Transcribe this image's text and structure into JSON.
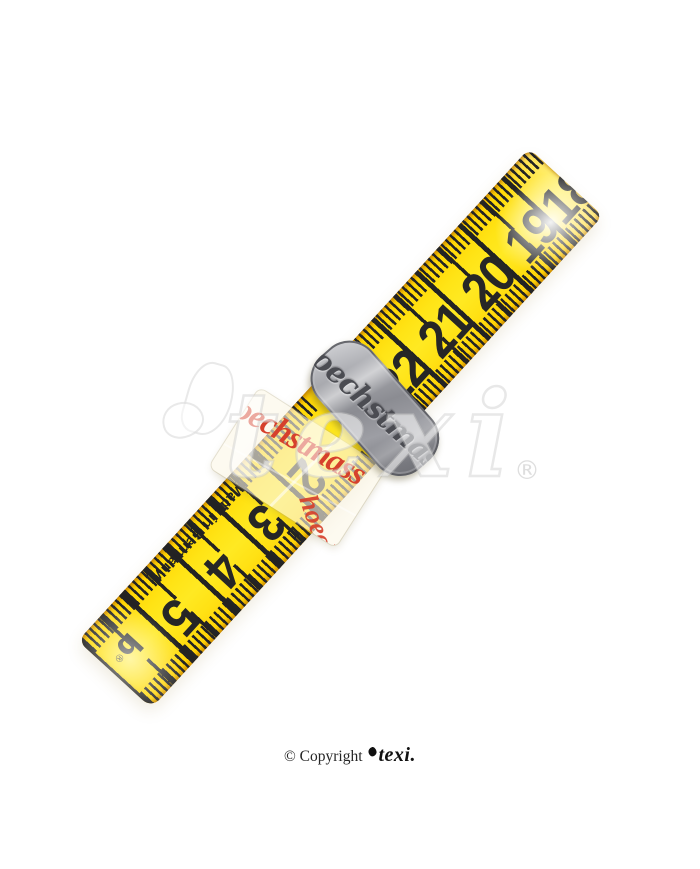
{
  "photo": {
    "background_color": "#ffffff",
    "tape": {
      "color_yellow": "#ffe114",
      "tick_color": "#232323",
      "upper_scale": [
        "18",
        "19",
        "20",
        "21",
        "22"
      ],
      "lower_scale": [
        "2",
        "3",
        "4",
        "5"
      ],
      "made_in_label": "Made in Germany",
      "tape_logo_letter": "b",
      "tape_logo_registered": "®"
    },
    "metal_clip": {
      "engraving": "hoechstmass",
      "color_metal": "#95969c"
    },
    "label_band": {
      "brand_text": "hoechstmass",
      "brand_text_fragment": "hoech",
      "text_color": "#d6402c"
    },
    "watermark": {
      "text": "texi",
      "registered_mark": "®"
    },
    "footer": {
      "copyright_prefix": "© Copyright",
      "brand": "texi."
    }
  }
}
